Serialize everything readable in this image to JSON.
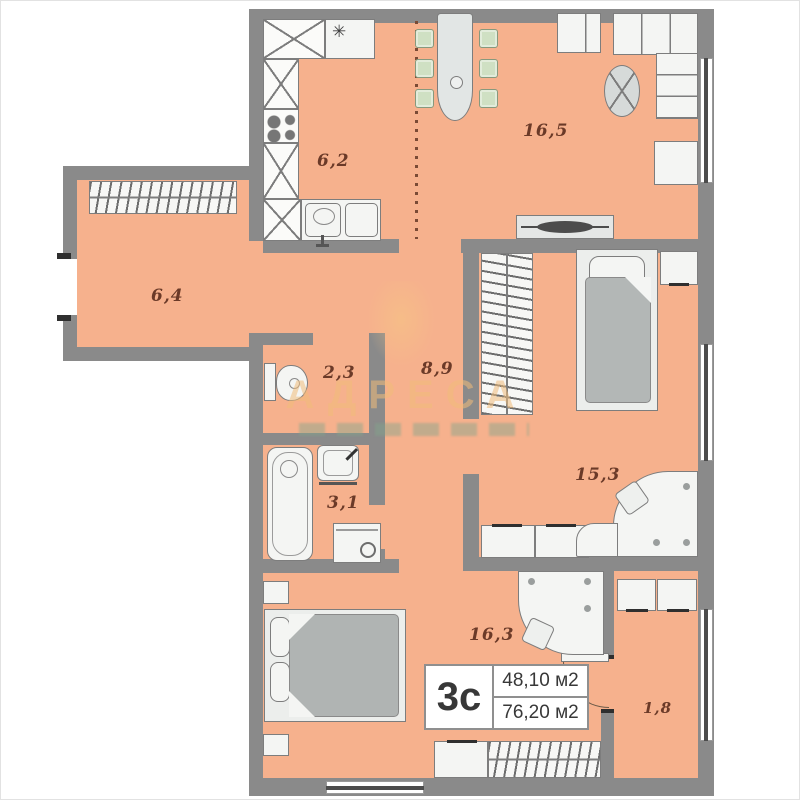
{
  "plan": {
    "watermark": {
      "brand": "АДРЕСА"
    },
    "info_box": {
      "code": "3с",
      "area_row1": "48,10 м2",
      "area_row2": "76,20 м2"
    },
    "rooms": {
      "kitchen": {
        "area": "6,2"
      },
      "living_room": {
        "area": "16,5"
      },
      "hallway": {
        "area": "6,4"
      },
      "toilet": {
        "area": "2,3"
      },
      "corridor": {
        "area": "8,9"
      },
      "bathroom": {
        "area": "3,1"
      },
      "bedroom_right": {
        "area": "15,3"
      },
      "bedroom_bottom": {
        "area": "16,3"
      },
      "balcony": {
        "area": "1,8"
      }
    },
    "icons": {
      "snowflake": "✳"
    },
    "colors": {
      "floor": "#f6b18d",
      "wall": "#8a8a8a",
      "watermark": "#f1bb7a",
      "label_text": "#6b3a28"
    }
  }
}
